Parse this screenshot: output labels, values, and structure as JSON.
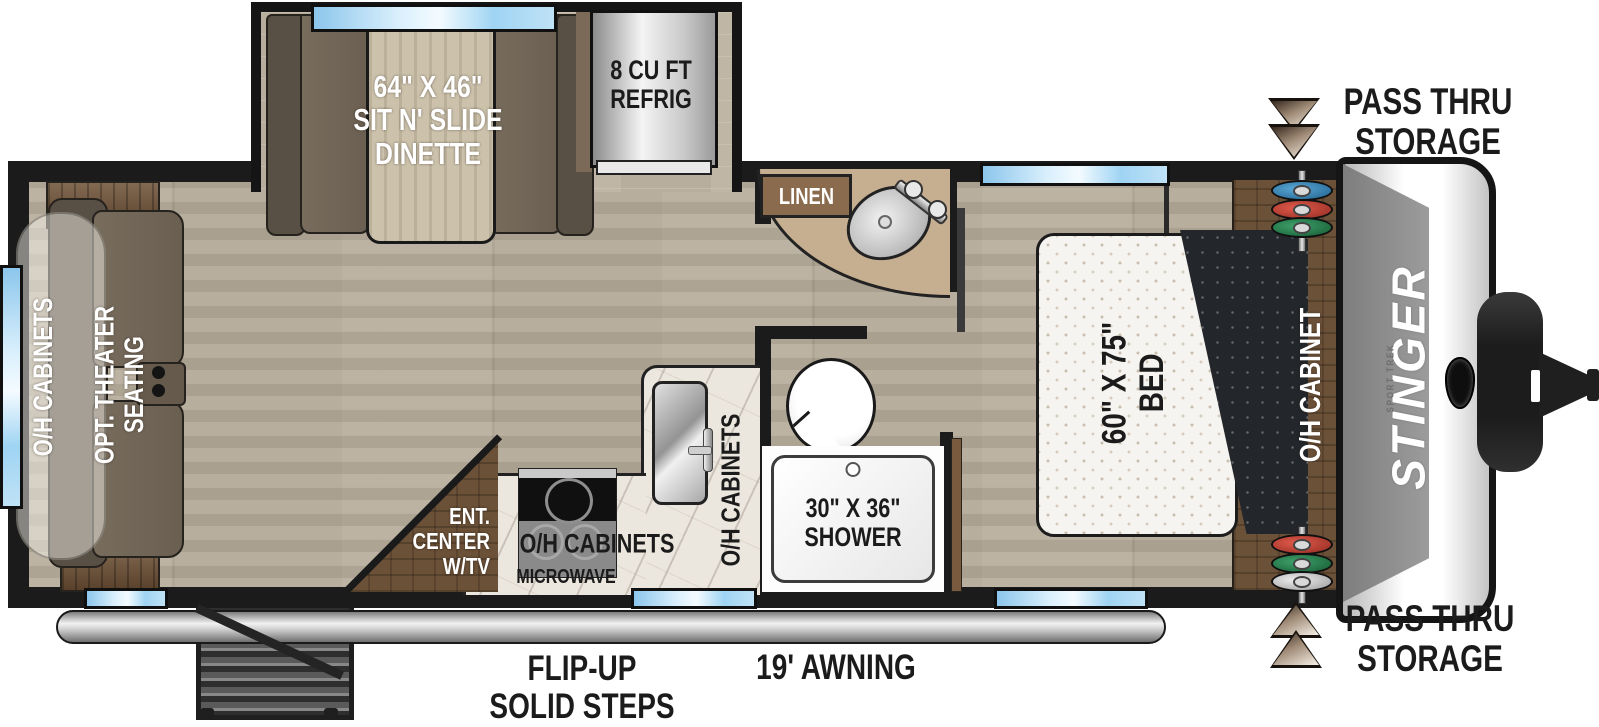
{
  "title": "Stinger travel trailer floorplan",
  "labels": {
    "dinette": {
      "l1": "64\" X 46\"",
      "l2": "SIT N' SLIDE",
      "l3": "DINETTE"
    },
    "refrig": {
      "l1": "8 CU FT",
      "l2": "REFRIG"
    },
    "linen": "LINEN",
    "pass_thru_top": {
      "l1": "PASS THRU",
      "l2": "STORAGE"
    },
    "pass_thru_bottom": {
      "l1": "PASS THRU",
      "l2": "STORAGE"
    },
    "bed": {
      "l1": "60\" X 75\"",
      "l2": "BED"
    },
    "oh_cabinet_bedroom": "O/H CABINET",
    "brand": "STINGER",
    "brand_sub": "SPORT TREK",
    "oh_cabinets_rear": "O/H CABINETS",
    "theater": {
      "l1": "OPT. THEATER",
      "l2": "SEATING"
    },
    "ent_center": {
      "l1": "ENT.",
      "l2": "CENTER",
      "l3": "W/TV"
    },
    "kitchen_oh_cabinets": "O/H CABINETS",
    "microwave": "MICROWAVE",
    "kitchen_oh_cabinets_vertical": "O/H CABINETS",
    "shower": {
      "l1": "30\" X 36\"",
      "l2": "SHOWER"
    },
    "steps": {
      "l1": "FLIP-UP",
      "l2": "SOLID STEPS"
    },
    "awning": "19' AWNING"
  },
  "colors": {
    "wall": "#1b1b1b",
    "window_blue": "#9fd4f3",
    "floor_wood": "#b3a998",
    "cabinet_wood": "#6b5138",
    "disc_blue": "#2e86c1",
    "disc_red": "#c0392b",
    "disc_green": "#1e8449",
    "disc_silver": "#c8c8c8",
    "label_dark": "#1b1b1b",
    "label_white": "#ffffff"
  }
}
